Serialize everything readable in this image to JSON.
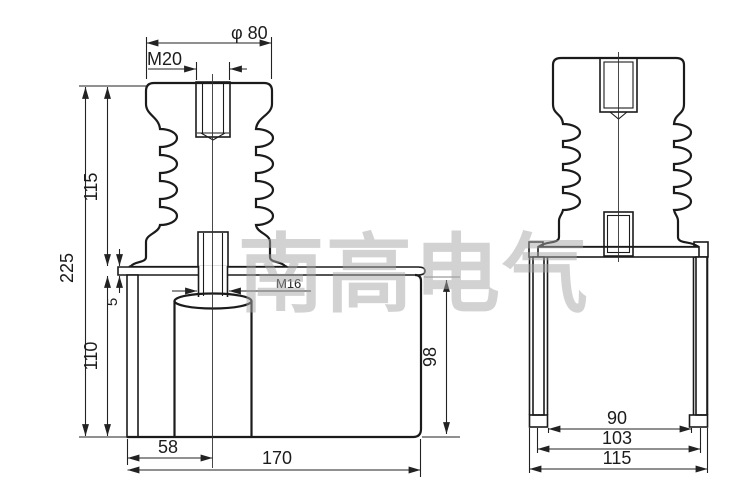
{
  "drawing": {
    "type": "technical-dimension-drawing",
    "watermark": "南高电气",
    "colors": {
      "line": "#1b1b1b",
      "dimension_line": "#222222",
      "extension_gray": "#9a9a9a",
      "watermark_gray": "#a6a6a6",
      "background": "#ffffff"
    },
    "front_view": {
      "dims": {
        "top_diameter": "φ 80",
        "top_thread": "M20",
        "total_height": "225",
        "insulator_height": "115",
        "flange_thickness": "5",
        "box_height": "110",
        "bottom_thread": "M16",
        "inner_height": "98",
        "center_offset": "58",
        "box_width": "170"
      }
    },
    "side_view": {
      "dims": {
        "inner_width": "90",
        "mid_width": "103",
        "outer_width": "115"
      }
    }
  }
}
